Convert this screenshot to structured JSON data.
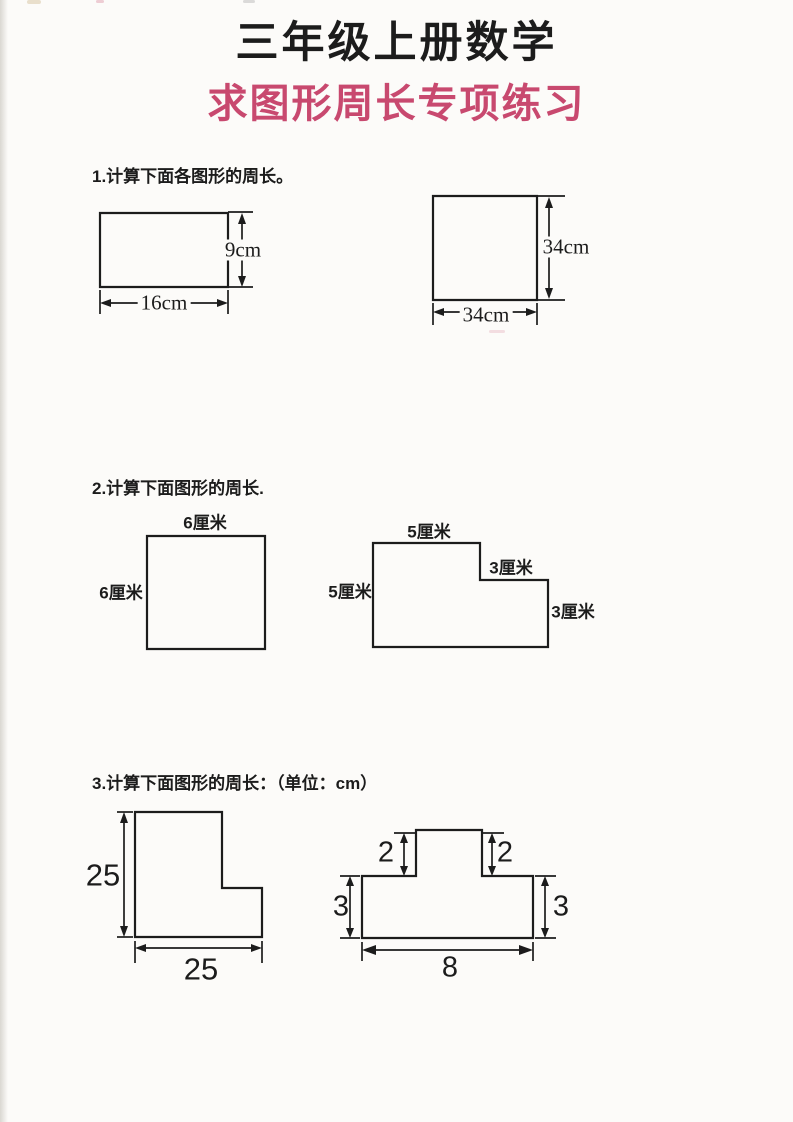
{
  "page": {
    "title": "三年级上册数学",
    "subtitle": "求图形周长专项练习",
    "colors": {
      "accent_pink": "#c8496f",
      "ink": "#1c1c1c",
      "paper": "#fcfbf9"
    }
  },
  "sections": [
    {
      "heading": "1.计算下面各图形的周长。",
      "figures": [
        {
          "shape": "rectangle",
          "width_label": "16cm",
          "height_label": "9cm"
        },
        {
          "shape": "square",
          "width_label": "34cm",
          "height_label": "34cm"
        }
      ]
    },
    {
      "heading": "2.计算下面图形的周长.",
      "figures": [
        {
          "shape": "square",
          "top_label": "6厘米",
          "left_label": "6厘米"
        },
        {
          "shape": "step",
          "top_label": "5厘米",
          "left_label": "5厘米",
          "step_label": "3厘米",
          "right_label": "3厘米"
        }
      ]
    },
    {
      "heading": "3.计算下面图形的周长：（单位：cm）",
      "figures": [
        {
          "shape": "l-shape",
          "left_label": "25",
          "bottom_label": "25"
        },
        {
          "shape": "t-shape",
          "notch_left_label": "2",
          "notch_right_label": "2",
          "side_left_label": "3",
          "side_right_label": "3",
          "bottom_label": "8"
        }
      ]
    }
  ]
}
